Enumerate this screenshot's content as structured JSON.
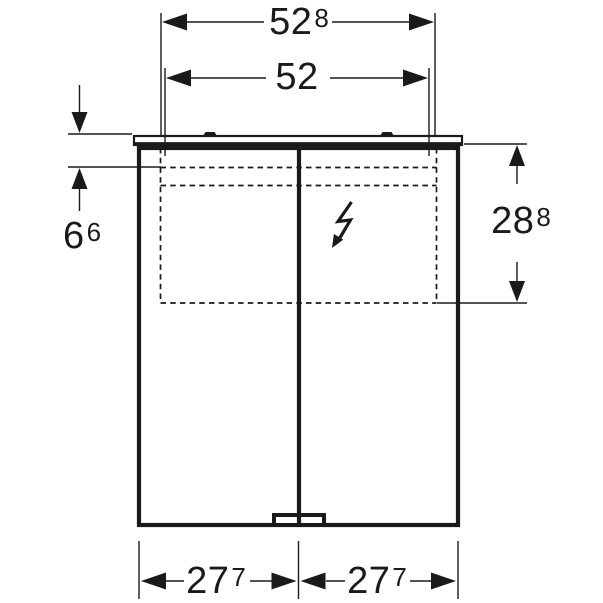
{
  "colors": {
    "background": "#ffffff",
    "line": "#1a1a1a"
  },
  "dimensions": {
    "top_outer": {
      "value": "52",
      "sup": "8"
    },
    "top_inner": {
      "value": "52",
      "sup": ""
    },
    "left": {
      "value": "6",
      "sup": "6"
    },
    "right": {
      "value": "28",
      "sup": "8"
    },
    "bottom_left": {
      "value": "27",
      "sup": "7"
    },
    "bottom_right": {
      "value": "27",
      "sup": "7"
    }
  },
  "icons": {
    "electrical": "lightning-bolt-arrow-icon"
  }
}
